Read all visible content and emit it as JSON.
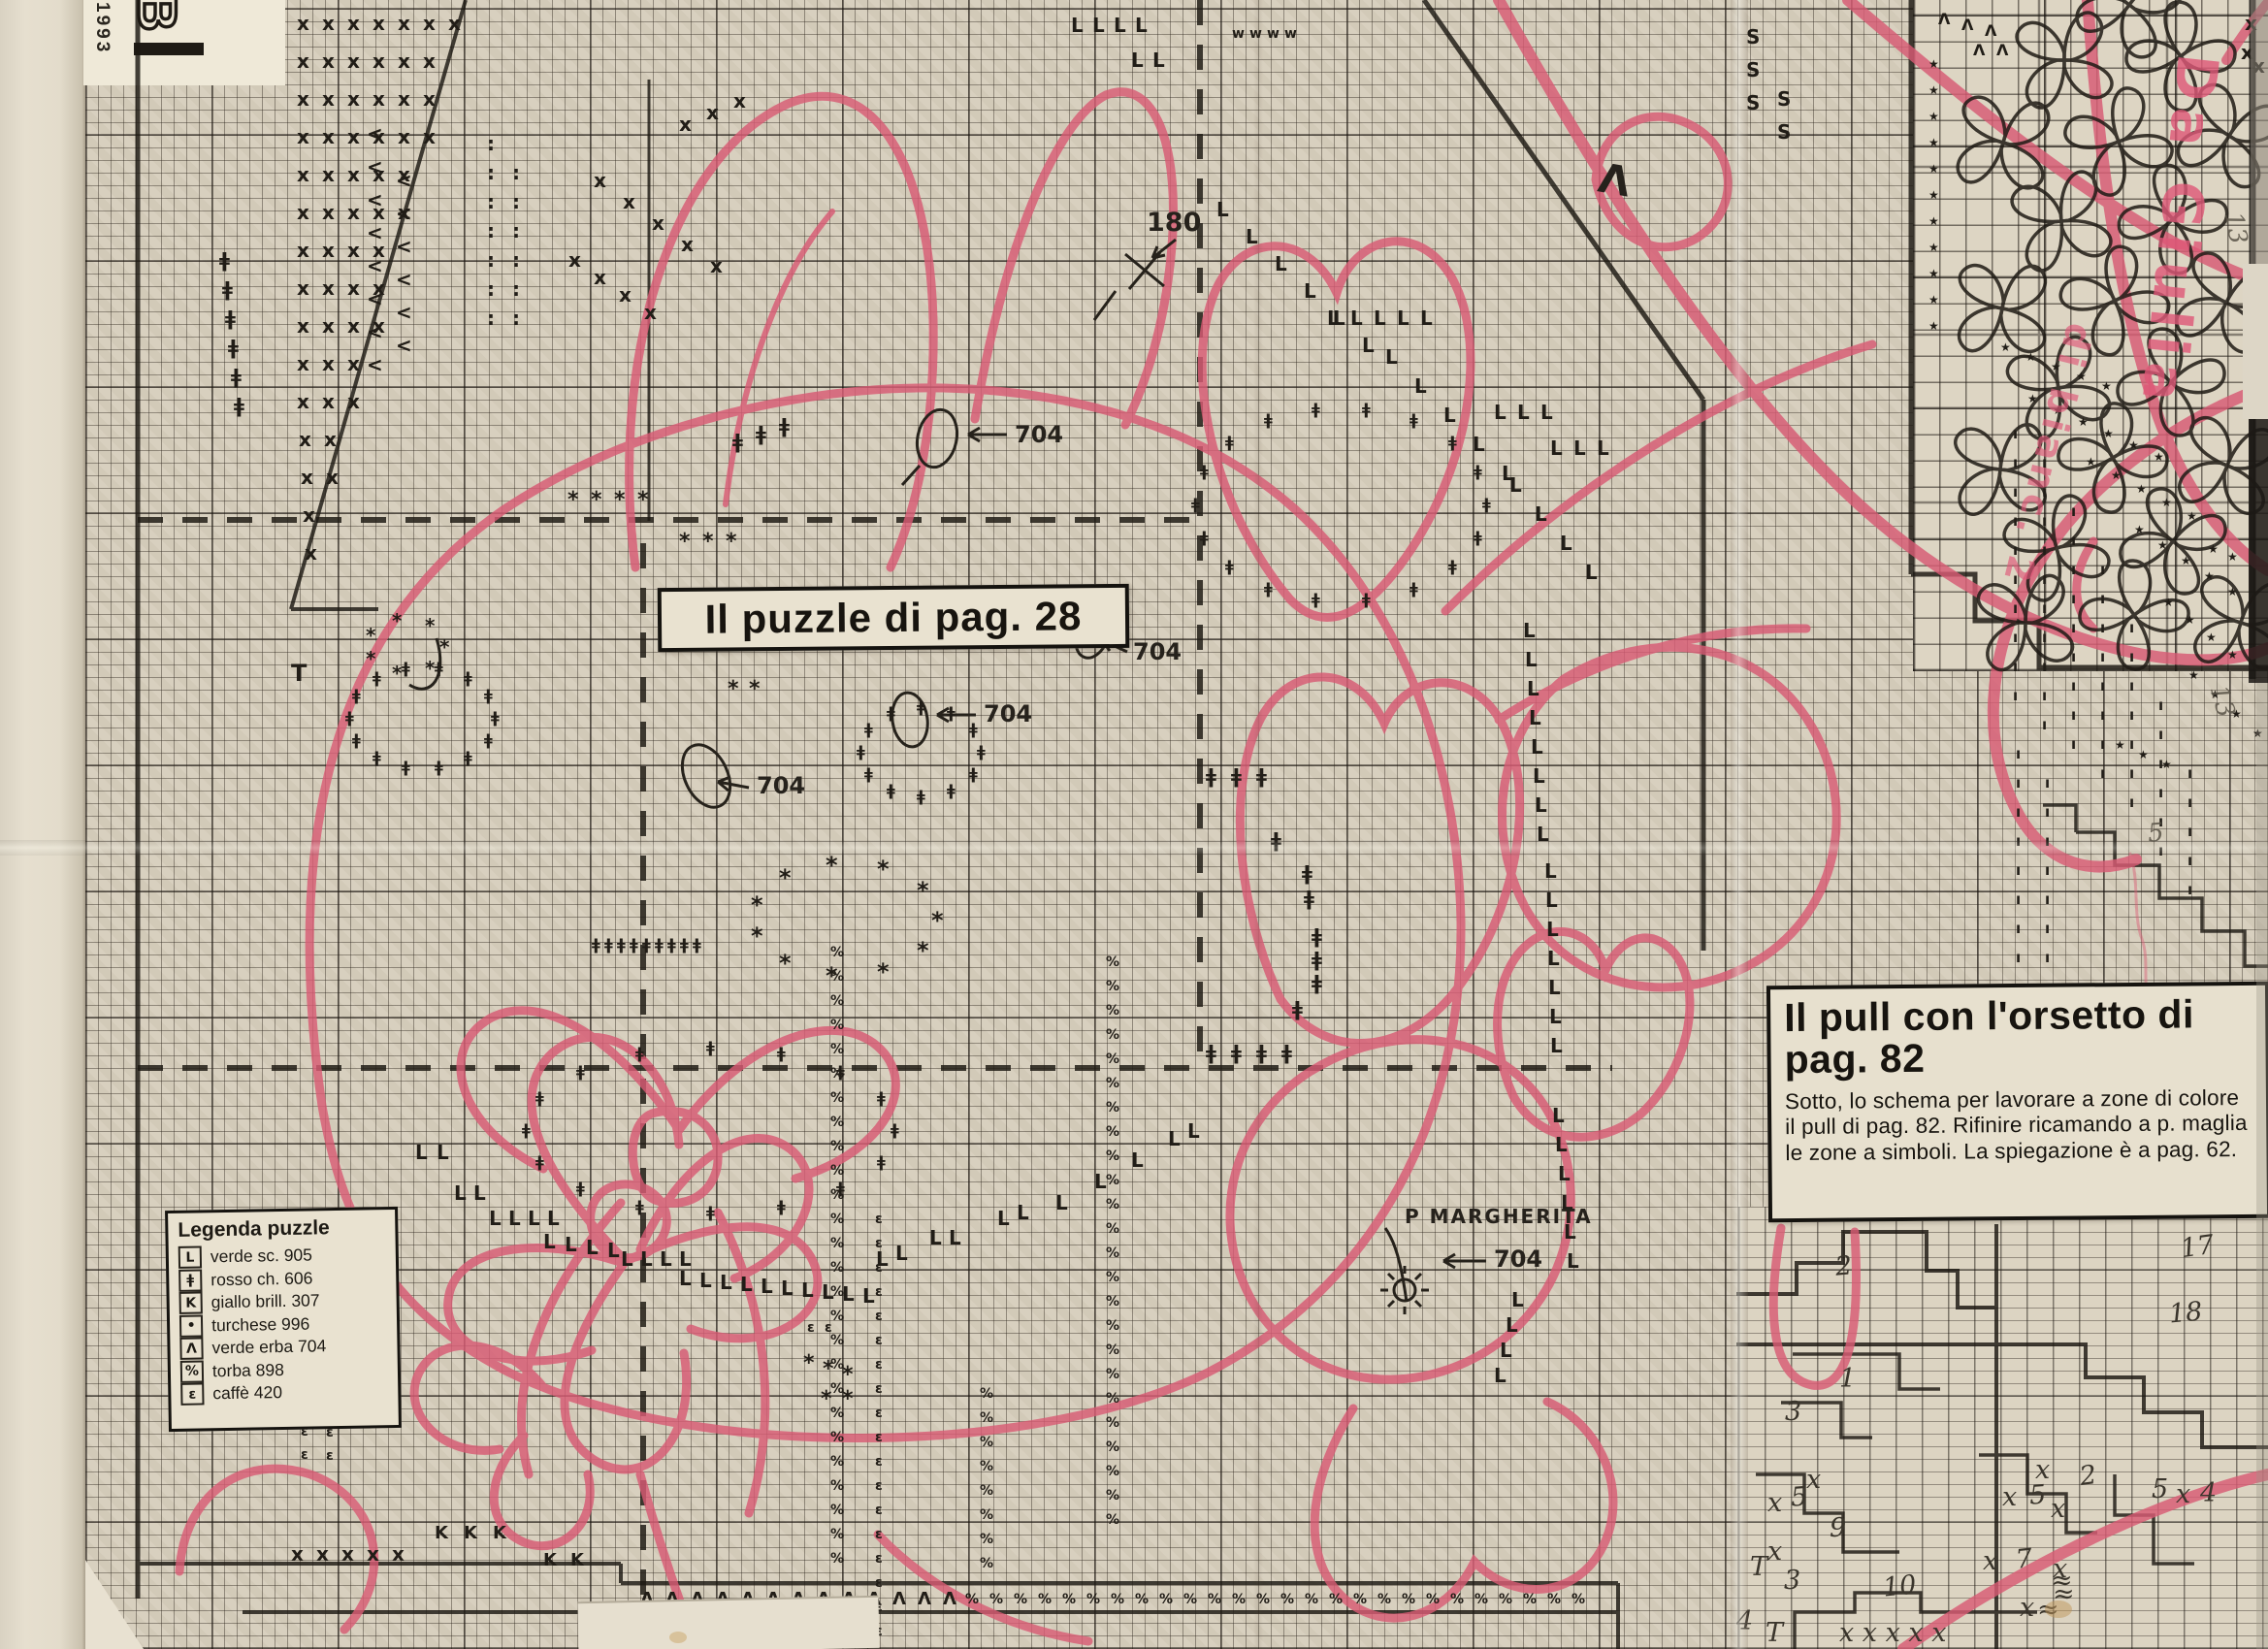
{
  "masthead": {
    "year": "1993",
    "letter": "B"
  },
  "boxes": {
    "puzzle_box": {
      "label": "Il puzzle di pag. 28"
    },
    "pull_box": {
      "title": "Il pull con l'orsetto di pag. 82",
      "body": "Sotto, lo schema per lavorare a zone di colore il pull di pag. 82. Rifinire ricamando a p. maglia le zone a simboli. La spiegazione è a pag. 62."
    }
  },
  "legend": {
    "title": "Legenda puzzle",
    "entries": [
      {
        "sym": "L",
        "label": "verde sc. 905"
      },
      {
        "sym": "ǂ",
        "label": "rosso ch. 606"
      },
      {
        "sym": "K",
        "label": "giallo brill. 307"
      },
      {
        "sym": "•",
        "label": "turchese 996"
      },
      {
        "sym": "Λ",
        "label": "verde erba 704"
      },
      {
        "sym": "%",
        "label": "torba 898"
      },
      {
        "sym": "ε",
        "label": "caffè 420"
      }
    ]
  },
  "annotations": {
    "code_704": "704",
    "count_180": "180",
    "margherita": "P MARGHERITA",
    "lambda": "Λ"
  },
  "pink_notes": {
    "note1": "Da Giulia",
    "note2": "di bianc. 2"
  },
  "pencil_notes": [
    [
      "13",
      2288,
      222,
      80
    ],
    [
      "13",
      2274,
      710,
      75
    ],
    [
      "5",
      2214,
      846,
      -5
    ]
  ],
  "edge_notes": [
    [
      "o",
      672,
      1664
    ],
    [
      "re",
      714,
      1666
    ],
    [
      "A",
      740,
      1664
    ],
    [
      "=",
      784,
      1660
    ]
  ],
  "zone_chart": {
    "labels": [
      [
        "2",
        1892,
        1292,
        -5
      ],
      [
        "17",
        2248,
        1272,
        -8
      ],
      [
        "18",
        2236,
        1340,
        -5
      ],
      [
        "1",
        1896,
        1408,
        0
      ],
      [
        "3",
        1840,
        1442,
        0
      ],
      [
        "x",
        1862,
        1512,
        0
      ],
      [
        "x",
        1822,
        1536,
        0
      ],
      [
        "5",
        1846,
        1530,
        -4
      ],
      [
        "9",
        1886,
        1562,
        0
      ],
      [
        "x",
        1822,
        1586,
        0
      ],
      [
        "T",
        1804,
        1602,
        0
      ],
      [
        "3",
        1839,
        1616,
        0
      ],
      [
        "10",
        1941,
        1622,
        -6
      ],
      [
        "4",
        1790,
        1658,
        0
      ],
      [
        "T",
        1820,
        1670,
        0
      ],
      [
        "x x x x x",
        1896,
        1670,
        0
      ],
      [
        "x",
        2098,
        1502,
        0
      ],
      [
        "2",
        2144,
        1508,
        -8
      ],
      [
        "x",
        2064,
        1530,
        0
      ],
      [
        "5",
        2092,
        1528,
        -4
      ],
      [
        "x",
        2114,
        1542,
        0
      ],
      [
        "x",
        2044,
        1596,
        0
      ],
      [
        "7",
        2078,
        1594,
        -6
      ],
      [
        "x",
        2116,
        1604,
        0
      ],
      [
        "≈",
        2114,
        1616,
        0
      ],
      [
        "≈",
        2116,
        1630,
        0
      ],
      [
        "x",
        2082,
        1644,
        0
      ],
      [
        "≈",
        2100,
        1646,
        0
      ],
      [
        "5",
        2218,
        1522,
        0
      ],
      [
        "x",
        2243,
        1527,
        0
      ],
      [
        "4",
        2268,
        1526,
        0
      ]
    ]
  },
  "pattern": {
    "colors": {
      "pink": "#d85b74",
      "ink": "#211d17",
      "paper": "#d8d0bf"
    },
    "runs": [
      [
        "x",
        306,
        14,
        7,
        26,
        0
      ],
      [
        "x",
        306,
        53,
        6,
        26,
        0
      ],
      [
        "x",
        306,
        92,
        6,
        26,
        0
      ],
      [
        "x",
        306,
        131,
        6,
        26,
        0
      ],
      [
        "x",
        306,
        170,
        5,
        26,
        0
      ],
      [
        "x",
        306,
        209,
        5,
        26,
        0
      ],
      [
        "x",
        306,
        248,
        4,
        26,
        0
      ],
      [
        "x",
        306,
        287,
        4,
        26,
        0
      ],
      [
        "x",
        306,
        326,
        4,
        26,
        0
      ],
      [
        "x",
        306,
        365,
        3,
        26,
        0
      ],
      [
        "x",
        306,
        404,
        3,
        26,
        0
      ],
      [
        "x",
        308,
        443,
        2,
        26,
        0
      ],
      [
        "x",
        310,
        482,
        2,
        26,
        0
      ],
      [
        "x",
        312,
        521,
        1,
        0,
        0
      ],
      [
        "x",
        314,
        560,
        1,
        0,
        0
      ],
      [
        "<",
        378,
        128,
        8,
        0,
        34
      ],
      [
        "<",
        408,
        176,
        6,
        0,
        34
      ],
      [
        ":",
        502,
        138,
        7,
        0,
        30
      ],
      [
        ":",
        528,
        168,
        6,
        0,
        30
      ],
      [
        "x",
        612,
        176,
        5,
        30,
        22
      ],
      [
        "x",
        586,
        258,
        4,
        26,
        18
      ],
      [
        "x",
        700,
        118,
        3,
        28,
        -12
      ],
      [
        "L",
        1104,
        16,
        4,
        22,
        0
      ],
      [
        "L",
        1166,
        52,
        2,
        22,
        0
      ],
      [
        "L",
        1254,
        206,
        6,
        30,
        28
      ],
      [
        "L",
        1368,
        318,
        5,
        24,
        0
      ],
      [
        "L",
        1428,
        358,
        5,
        30,
        30
      ],
      [
        "L",
        1540,
        415,
        3,
        24,
        0
      ],
      [
        "L",
        1556,
        490,
        4,
        26,
        30
      ],
      [
        "L",
        1598,
        452,
        3,
        24,
        0
      ],
      [
        "L",
        1570,
        640,
        8,
        2,
        30
      ],
      [
        "L",
        1592,
        888,
        7,
        1,
        30
      ],
      [
        "L",
        1600,
        1140,
        6,
        3,
        30
      ],
      [
        "L",
        1558,
        1330,
        4,
        -6,
        26
      ],
      [
        "L",
        428,
        1178,
        2,
        22,
        0
      ],
      [
        "L",
        468,
        1220,
        2,
        20,
        0
      ],
      [
        "L",
        504,
        1246,
        4,
        20,
        0
      ],
      [
        "L",
        560,
        1270,
        4,
        22,
        3
      ],
      [
        "L",
        640,
        1288,
        4,
        20,
        0
      ],
      [
        "L",
        700,
        1308,
        10,
        21,
        2
      ],
      [
        "L",
        903,
        1288,
        2,
        20,
        -6
      ],
      [
        "L",
        958,
        1266,
        2,
        20,
        0
      ],
      [
        "L",
        1028,
        1246,
        2,
        20,
        -6
      ],
      [
        "L",
        1088,
        1230,
        1,
        0,
        0
      ],
      [
        "L",
        1128,
        1208,
        1,
        0,
        0
      ],
      [
        "L",
        1166,
        1186,
        1,
        0,
        0
      ],
      [
        "L",
        1204,
        1164,
        2,
        20,
        -8
      ],
      [
        "ǂ",
        610,
        966,
        9,
        13,
        0,
        16
      ],
      [
        "ǂ",
        226,
        258,
        6,
        3,
        30
      ],
      [
        "ǂ",
        1243,
        790,
        3,
        26,
        0
      ],
      [
        "ǂ",
        1310,
        856,
        1,
        0,
        0
      ],
      [
        "ǂ",
        1342,
        890,
        2,
        2,
        26
      ],
      [
        "ǂ",
        1352,
        955,
        3,
        0,
        24
      ],
      [
        "ǂ",
        1332,
        1030,
        1,
        0,
        0
      ],
      [
        "ǂ",
        1243,
        1075,
        4,
        26,
        0
      ],
      [
        "ǂ",
        755,
        445,
        3,
        24,
        -8
      ],
      [
        "*",
        585,
        505,
        4,
        24,
        0,
        22
      ],
      [
        "*",
        700,
        548,
        3,
        24,
        0,
        22
      ],
      [
        "*",
        750,
        700,
        2,
        22,
        0,
        22
      ],
      [
        "*",
        828,
        1395,
        3,
        20,
        6,
        22
      ],
      [
        "*",
        846,
        1432,
        2,
        22,
        0,
        22
      ],
      [
        "★",
        1988,
        60,
        11,
        0,
        27,
        12
      ],
      [
        "★",
        2062,
        352,
        5,
        26,
        10,
        12
      ],
      [
        "★",
        2090,
        405,
        6,
        26,
        12,
        12
      ],
      [
        "★",
        2150,
        470,
        5,
        26,
        14,
        12
      ],
      [
        "★",
        2200,
        540,
        5,
        24,
        16,
        12
      ],
      [
        "★",
        2230,
        615,
        4,
        22,
        18,
        12
      ],
      [
        "★",
        2256,
        690,
        4,
        22,
        20,
        12
      ],
      [
        "★",
        2180,
        762,
        3,
        24,
        10,
        12
      ],
      [
        "★",
        2276,
        560,
        2,
        20,
        8,
        12
      ],
      [
        "Λ",
        660,
        1640,
        13,
        26,
        0,
        18
      ],
      [
        "Λ",
        1998,
        12,
        3,
        24,
        6,
        16
      ],
      [
        "Λ",
        2034,
        44,
        2,
        24,
        0,
        16
      ],
      [
        "x",
        2314,
        14,
        1,
        0,
        0
      ],
      [
        "x",
        2310,
        44,
        2,
        12,
        14
      ],
      [
        "S",
        1800,
        28,
        3,
        0,
        34,
        20
      ],
      [
        "S",
        1832,
        92,
        2,
        0,
        34,
        20
      ],
      [
        "w",
        1270,
        28,
        4,
        18,
        0,
        14
      ],
      [
        "%",
        856,
        975,
        26,
        0,
        25,
        14
      ],
      [
        "%",
        1140,
        985,
        24,
        0,
        25,
        14
      ],
      [
        "%",
        1010,
        1430,
        8,
        0,
        25,
        14
      ],
      [
        "%",
        995,
        1642,
        26,
        25,
        0,
        14
      ],
      [
        "ε",
        902,
        1250,
        18,
        0,
        25,
        14
      ],
      [
        "ε",
        310,
        1445,
        3,
        0,
        24,
        14
      ],
      [
        "ε",
        336,
        1470,
        2,
        0,
        24,
        14
      ],
      [
        "ε",
        832,
        1362,
        2,
        18,
        0,
        14
      ],
      [
        "K",
        448,
        1572,
        3,
        30,
        0,
        18
      ],
      [
        "K",
        560,
        1600,
        2,
        28,
        0,
        18
      ],
      [
        "x",
        300,
        1592,
        5,
        26,
        0
      ],
      [
        "ı",
        2075,
        440,
        10,
        0,
        30,
        15
      ],
      [
        "ı",
        2105,
        470,
        10,
        0,
        30,
        15
      ],
      [
        "ı",
        2135,
        520,
        9,
        0,
        30,
        15
      ],
      [
        "ı",
        2165,
        580,
        8,
        0,
        30,
        15
      ],
      [
        "ı",
        2195,
        640,
        7,
        0,
        30,
        15
      ],
      [
        "ı",
        2225,
        720,
        6,
        0,
        30,
        15
      ],
      [
        "ı",
        2255,
        790,
        5,
        0,
        30,
        15
      ],
      [
        "ı",
        2078,
        770,
        8,
        0,
        30,
        15
      ],
      [
        "ı",
        2108,
        800,
        7,
        0,
        30,
        15
      ],
      [
        "T",
        300,
        682,
        1,
        0,
        0,
        24
      ]
    ],
    "rings": [
      [
        "ǂ",
        1385,
        520,
        150,
        100,
        18,
        16
      ],
      [
        "ǂ",
        438,
        740,
        75,
        52,
        14,
        16
      ],
      [
        "ǂ",
        952,
        775,
        62,
        46,
        12,
        16
      ],
      [
        "ǂ",
        735,
        1165,
        190,
        85,
        16,
        16
      ],
      [
        "*",
        872,
        945,
        95,
        58,
        11,
        24
      ],
      [
        "*",
        420,
        665,
        40,
        28,
        7,
        20
      ]
    ],
    "flowers": [
      [
        2195,
        5
      ],
      [
        2128,
        62
      ],
      [
        2248,
        58
      ],
      [
        2065,
        147
      ],
      [
        2184,
        146
      ],
      [
        2298,
        140
      ],
      [
        2125,
        228
      ],
      [
        2240,
        226
      ],
      [
        2064,
        318
      ],
      [
        2180,
        310
      ],
      [
        2295,
        312
      ],
      [
        2122,
        400
      ],
      [
        2238,
        394
      ],
      [
        2062,
        484
      ],
      [
        2178,
        472
      ],
      [
        2296,
        480
      ],
      [
        2120,
        565
      ],
      [
        2240,
        558
      ],
      [
        2088,
        642
      ],
      [
        2200,
        634
      ],
      [
        2310,
        642
      ]
    ]
  }
}
